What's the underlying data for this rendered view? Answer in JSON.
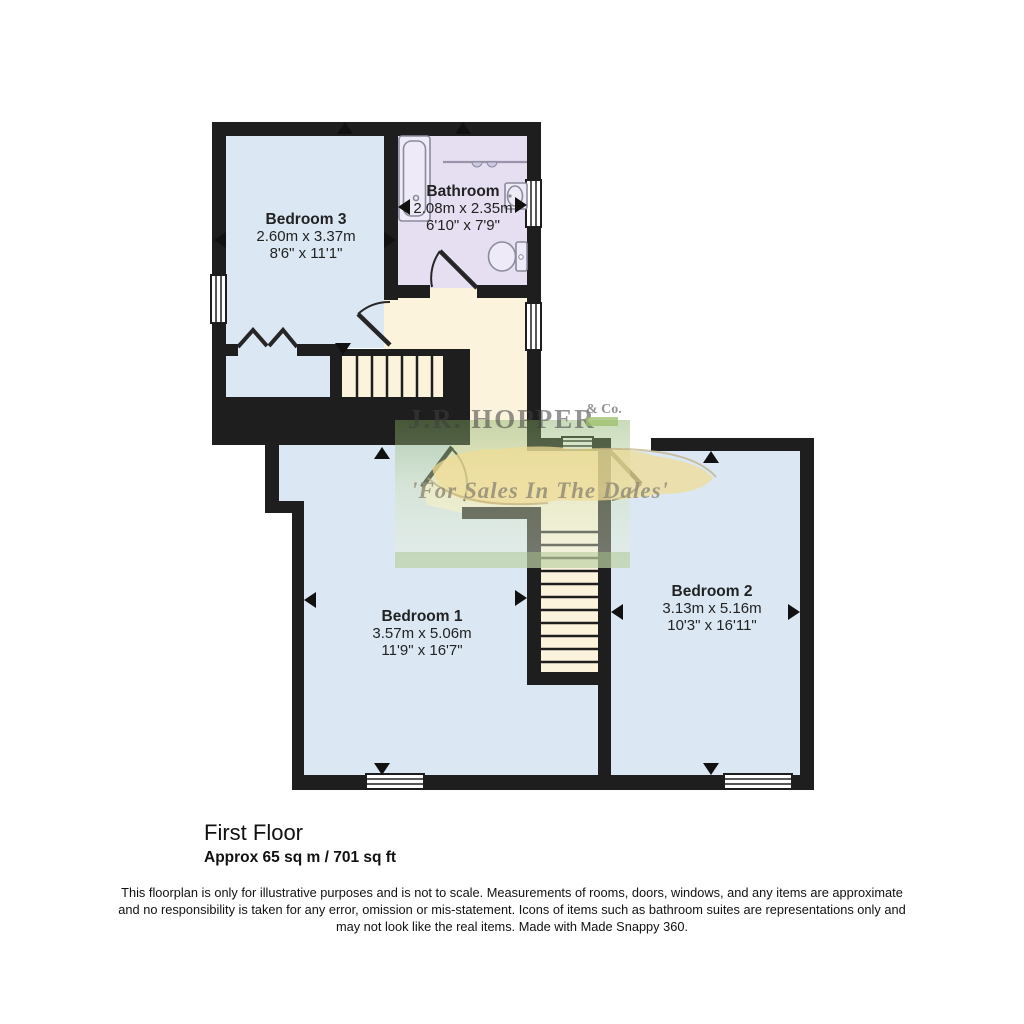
{
  "watermark": {
    "brand": "J.R. HOPPER",
    "brand_suffix": "& Co.",
    "tagline": "'For Sales In The Dales'"
  },
  "rooms": {
    "bedroom3": {
      "name": "Bedroom 3",
      "metric": "2.60m x 3.37m",
      "imperial": "8'6\" x 11'1\""
    },
    "bathroom": {
      "name": "Bathroom",
      "metric": "2.08m x 2.35m",
      "imperial": "6'10\" x 7'9\""
    },
    "bedroom1": {
      "name": "Bedroom 1",
      "metric": "3.57m x 5.06m",
      "imperial": "11'9\" x 16'7\""
    },
    "bedroom2": {
      "name": "Bedroom 2",
      "metric": "3.13m x 5.16m",
      "imperial": "10'3\" x 16'11\""
    }
  },
  "footer": {
    "floor_title": "First Floor",
    "floor_area": "Approx 65 sq m / 701 sq ft",
    "disclaimer_lines": [
      "This floorplan is only for illustrative purposes and is not to scale. Measurements of rooms, doors, windows, and any items are approximate",
      "and no responsibility is taken for any error, omission or mis-statement. Icons of items such as bathroom suites are representations only and",
      "may not look like the real items. Made with Made Snappy 360."
    ]
  },
  "colors": {
    "room_fill": "#dbe8f4",
    "bathroom_fill": "#e6dff2",
    "landing_fill": "#fbf3dc",
    "wall": "#1e1e1e",
    "watermark_green": "#8fb573",
    "watermark_yellow": "#efdc96",
    "logo_badge": "#9bbf6a"
  }
}
